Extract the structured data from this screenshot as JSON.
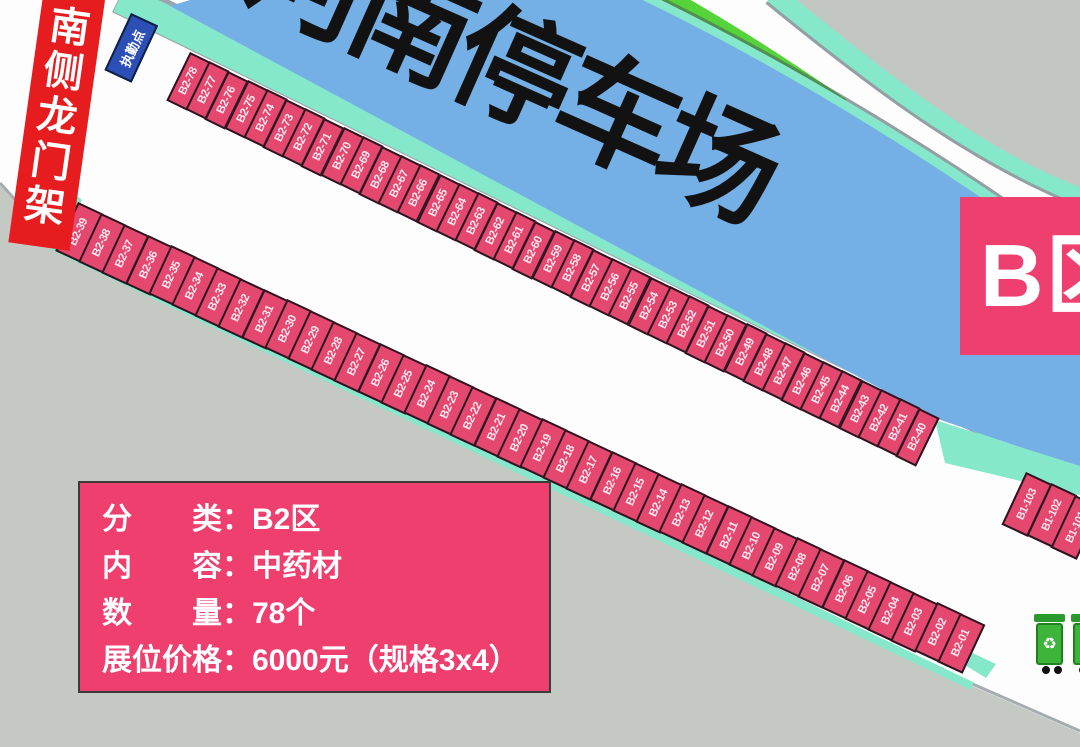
{
  "map": {
    "parking_band_title": "河南停车场",
    "zone_badge": "B区",
    "gantry_banner": "南侧龙门架",
    "duty_point_label": "执勤点",
    "recycle_icon": "♻"
  },
  "info_box": {
    "lines": [
      "分　　类：B2区",
      "内　　容：中药材",
      "数　　量：78个",
      "展位价格：6000元（规格3x4）"
    ]
  },
  "stall_rows": [
    {
      "id": "b2-upper",
      "labels": [
        "B2-78",
        "B2-77",
        "B2-76",
        "B2-75",
        "B2-74",
        "B2-73",
        "B2-72",
        "B2-71",
        "B2-70",
        "B2-69",
        "B2-68",
        "B2-67",
        "B2-66",
        "B2-65",
        "B2-64",
        "B2-63",
        "B2-62",
        "B2-61",
        "B2-60",
        "B2-59",
        "B2-58",
        "B2-57",
        "B2-56",
        "B2-55",
        "B2-54",
        "B2-53",
        "B2-52",
        "B2-51",
        "B2-50",
        "B2-49",
        "B2-48",
        "B2-47",
        "B2-46",
        "B2-45",
        "B2-44",
        "B2-43",
        "B2-42",
        "B2-41",
        "B2-40"
      ]
    },
    {
      "id": "b2-lower",
      "labels": [
        "B2-39",
        "B2-38",
        "B2-37",
        "B2-36",
        "B2-35",
        "B2-34",
        "B2-33",
        "B2-32",
        "B2-31",
        "B2-30",
        "B2-29",
        "B2-28",
        "B2-27",
        "B2-26",
        "B2-25",
        "B2-24",
        "B2-23",
        "B2-22",
        "B2-21",
        "B2-20",
        "B2-19",
        "B2-18",
        "B2-17",
        "B2-16",
        "B2-15",
        "B2-14",
        "B2-13",
        "B2-12",
        "B2-11",
        "B2-10",
        "B2-09",
        "B2-08",
        "B2-07",
        "B2-06",
        "B2-05",
        "B2-04",
        "B2-03",
        "B2-02",
        "B2-01"
      ]
    },
    {
      "id": "b1-corner",
      "labels": [
        "B1-103",
        "B1-102",
        "B1-101"
      ]
    }
  ],
  "colors": {
    "stall_pink": "#e5486f",
    "panel_pink": "#ee3f6f",
    "banner_red": "#e61c1f",
    "parking_blue": "#74b0e6",
    "duty_blue": "#2c4fb5",
    "walkway_teal": "#85e8ca",
    "lawn_green": "#55d439",
    "road_grey": "#c4c9c4",
    "bin_green": "#3cb53a"
  }
}
